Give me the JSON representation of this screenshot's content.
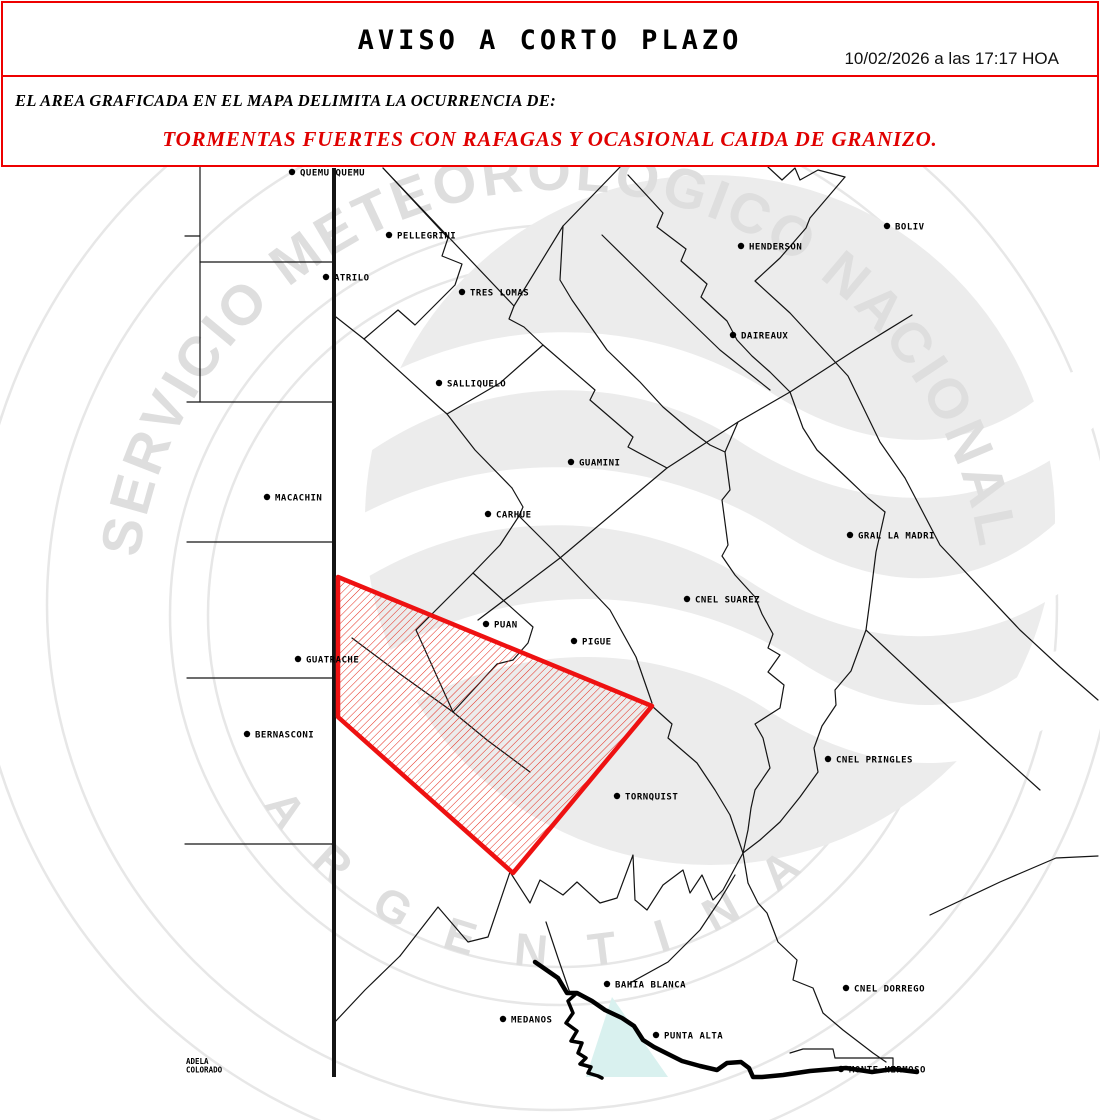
{
  "header": {
    "title": "AVISO A CORTO PLAZO",
    "timestamp": "10/02/2026 a las 17:17 HOA"
  },
  "advisory": {
    "intro": "EL AREA GRAFICADA EN EL MAPA DELIMITA LA OCURRENCIA DE:",
    "hazard": "TORMENTAS FUERTES CON RAFAGAS Y OCASIONAL CAIDA DE GRANIZO."
  },
  "map": {
    "colors": {
      "boundary": "#141414",
      "warning_red": "#ee1111",
      "hatch_red": "#e52819",
      "water": "#d9f1ef",
      "watermark": "#e7e7e7",
      "watermark_text": "#dedede",
      "logo_gray": "#ececec"
    },
    "watermark": {
      "arc_top": "SERVICIO METEOROLÓGICO NACIONAL",
      "arc_bottom": "A R G E N T I N A"
    },
    "province_border": {
      "x": 334,
      "y1": 168,
      "y2": 1077,
      "width": 4
    },
    "warning_area": {
      "points": [
        [
          338,
          577
        ],
        [
          652,
          706
        ],
        [
          513,
          873
        ],
        [
          338,
          717
        ]
      ]
    },
    "water_body": {
      "points": [
        [
          612,
          997
        ],
        [
          586,
          1077
        ],
        [
          668,
          1077
        ]
      ]
    },
    "coastline": [
      [
        535,
        962
      ],
      [
        558,
        978
      ],
      [
        567,
        993
      ],
      [
        577,
        993
      ],
      [
        592,
        1001
      ],
      [
        605,
        1010
      ],
      [
        622,
        1018
      ],
      [
        634,
        1026
      ],
      [
        643,
        1040
      ],
      [
        654,
        1047
      ],
      [
        668,
        1054
      ],
      [
        682,
        1061
      ],
      [
        700,
        1066
      ],
      [
        717,
        1070
      ],
      [
        727,
        1063
      ],
      [
        741,
        1062
      ],
      [
        749,
        1068
      ],
      [
        753,
        1077
      ],
      [
        762,
        1077
      ],
      [
        783,
        1075
      ],
      [
        810,
        1071
      ],
      [
        846,
        1068
      ],
      [
        872,
        1072
      ],
      [
        893,
        1069
      ],
      [
        917,
        1072
      ]
    ],
    "estuary_line": [
      [
        577,
        993
      ],
      [
        568,
        1001
      ],
      [
        573,
        1013
      ],
      [
        566,
        1023
      ],
      [
        577,
        1031
      ],
      [
        571,
        1041
      ],
      [
        582,
        1043
      ],
      [
        578,
        1053
      ],
      [
        586,
        1058
      ],
      [
        580,
        1064
      ],
      [
        591,
        1067
      ],
      [
        588,
        1073
      ],
      [
        598,
        1076
      ],
      [
        602,
        1078
      ]
    ],
    "boundaries": [
      [
        [
          185,
          236
        ],
        [
          200,
          236
        ]
      ],
      [
        [
          200,
          165
        ],
        [
          200,
          402
        ]
      ],
      [
        [
          200,
          262
        ],
        [
          334,
          262
        ]
      ],
      [
        [
          187,
          402
        ],
        [
          334,
          402
        ]
      ],
      [
        [
          187,
          542
        ],
        [
          334,
          542
        ]
      ],
      [
        [
          187,
          678
        ],
        [
          334,
          678
        ]
      ],
      [
        [
          185,
          844
        ],
        [
          334,
          844
        ]
      ],
      [
        [
          383,
          168
        ],
        [
          448,
          238
        ],
        [
          442,
          256
        ],
        [
          462,
          264
        ],
        [
          455,
          285
        ],
        [
          415,
          325
        ],
        [
          398,
          310
        ],
        [
          364,
          339
        ],
        [
          336,
          317
        ]
      ],
      [
        [
          383,
          168
        ],
        [
          514,
          306
        ],
        [
          509,
          319
        ],
        [
          524,
          327
        ],
        [
          543,
          345
        ]
      ],
      [
        [
          622,
          165
        ],
        [
          563,
          226
        ],
        [
          514,
          306
        ]
      ],
      [
        [
          364,
          339
        ],
        [
          440,
          408
        ],
        [
          447,
          414
        ],
        [
          475,
          450
        ],
        [
          512,
          488
        ]
      ],
      [
        [
          543,
          345
        ],
        [
          500,
          383
        ],
        [
          447,
          414
        ]
      ],
      [
        [
          543,
          345
        ],
        [
          595,
          390
        ],
        [
          590,
          400
        ],
        [
          633,
          437
        ],
        [
          628,
          447
        ],
        [
          667,
          468
        ]
      ],
      [
        [
          512,
          488
        ],
        [
          523,
          507
        ],
        [
          519,
          516
        ],
        [
          553,
          550
        ],
        [
          610,
          610
        ],
        [
          636,
          657
        ],
        [
          652,
          703
        ]
      ],
      [
        [
          519,
          516
        ],
        [
          500,
          545
        ],
        [
          473,
          573
        ]
      ],
      [
        [
          473,
          573
        ],
        [
          533,
          627
        ],
        [
          528,
          643
        ],
        [
          513,
          660
        ]
      ],
      [
        [
          473,
          573
        ],
        [
          443,
          603
        ],
        [
          416,
          630
        ]
      ],
      [
        [
          513,
          660
        ],
        [
          497,
          664
        ],
        [
          453,
          712
        ]
      ],
      [
        [
          416,
          630
        ],
        [
          453,
          712
        ]
      ],
      [
        [
          453,
          712
        ],
        [
          487,
          740
        ],
        [
          530,
          772
        ]
      ],
      [
        [
          352,
          638
        ],
        [
          400,
          674
        ],
        [
          453,
          712
        ]
      ],
      [
        [
          478,
          620
        ],
        [
          560,
          558
        ],
        [
          667,
          468
        ],
        [
          738,
          422
        ],
        [
          790,
          392
        ],
        [
          855,
          350
        ],
        [
          912,
          315
        ]
      ],
      [
        [
          738,
          422
        ],
        [
          725,
          452
        ],
        [
          730,
          490
        ],
        [
          722,
          500
        ],
        [
          728,
          545
        ],
        [
          722,
          556
        ],
        [
          735,
          575
        ],
        [
          755,
          597
        ],
        [
          762,
          614
        ],
        [
          773,
          634
        ],
        [
          768,
          648
        ],
        [
          780,
          655
        ],
        [
          768,
          672
        ],
        [
          784,
          685
        ],
        [
          780,
          708
        ],
        [
          755,
          724
        ],
        [
          763,
          738
        ],
        [
          770,
          768
        ],
        [
          755,
          790
        ],
        [
          751,
          808
        ],
        [
          748,
          830
        ],
        [
          743,
          853
        ]
      ],
      [
        [
          628,
          175
        ],
        [
          663,
          213
        ],
        [
          657,
          227
        ],
        [
          686,
          249
        ],
        [
          681,
          261
        ],
        [
          707,
          284
        ],
        [
          701,
          297
        ],
        [
          727,
          321
        ],
        [
          737,
          340
        ],
        [
          752,
          356
        ],
        [
          770,
          372
        ],
        [
          790,
          392
        ]
      ],
      [
        [
          790,
          392
        ],
        [
          803,
          428
        ],
        [
          817,
          450
        ],
        [
          847,
          478
        ],
        [
          868,
          498
        ],
        [
          885,
          512
        ]
      ],
      [
        [
          845,
          177
        ],
        [
          810,
          218
        ],
        [
          806,
          228
        ],
        [
          780,
          258
        ],
        [
          755,
          281
        ],
        [
          790,
          313
        ],
        [
          848,
          376
        ],
        [
          880,
          442
        ],
        [
          905,
          478
        ],
        [
          940,
          545
        ],
        [
          1020,
          630
        ],
        [
          1060,
          667
        ],
        [
          1098,
          700
        ]
      ],
      [
        [
          768,
          167
        ],
        [
          782,
          180
        ],
        [
          795,
          168
        ],
        [
          800,
          180
        ],
        [
          818,
          170
        ],
        [
          845,
          177
        ]
      ],
      [
        [
          602,
          235
        ],
        [
          660,
          292
        ],
        [
          720,
          350
        ],
        [
          770,
          390
        ]
      ],
      [
        [
          563,
          226
        ],
        [
          560,
          280
        ],
        [
          572,
          300
        ],
        [
          607,
          350
        ],
        [
          640,
          382
        ],
        [
          663,
          407
        ],
        [
          690,
          430
        ],
        [
          710,
          445
        ],
        [
          725,
          452
        ]
      ],
      [
        [
          885,
          512
        ],
        [
          876,
          552
        ],
        [
          870,
          600
        ],
        [
          866,
          630
        ],
        [
          851,
          671
        ],
        [
          835,
          690
        ],
        [
          836,
          705
        ],
        [
          822,
          726
        ],
        [
          814,
          748
        ],
        [
          818,
          772
        ],
        [
          800,
          797
        ],
        [
          780,
          822
        ],
        [
          760,
          840
        ],
        [
          743,
          853
        ]
      ],
      [
        [
          866,
          630
        ],
        [
          930,
          690
        ],
        [
          990,
          745
        ],
        [
          1040,
          790
        ]
      ],
      [
        [
          930,
          915
        ],
        [
          1000,
          882
        ],
        [
          1056,
          858
        ],
        [
          1098,
          856
        ]
      ],
      [
        [
          743,
          853
        ],
        [
          748,
          883
        ],
        [
          758,
          903
        ],
        [
          767,
          913
        ],
        [
          778,
          942
        ],
        [
          797,
          960
        ],
        [
          793,
          980
        ],
        [
          813,
          988
        ],
        [
          823,
          1013
        ],
        [
          843,
          1030
        ],
        [
          873,
          1053
        ],
        [
          886,
          1062
        ]
      ],
      [
        [
          400,
          956
        ],
        [
          438,
          907
        ],
        [
          468,
          942
        ],
        [
          488,
          937
        ],
        [
          510,
          872
        ],
        [
          530,
          903
        ],
        [
          540,
          880
        ],
        [
          563,
          895
        ],
        [
          577,
          882
        ],
        [
          600,
          903
        ],
        [
          617,
          898
        ],
        [
          633,
          855
        ],
        [
          635,
          900
        ],
        [
          647,
          910
        ],
        [
          663,
          885
        ],
        [
          683,
          870
        ],
        [
          690,
          893
        ],
        [
          702,
          875
        ],
        [
          713,
          900
        ],
        [
          723,
          890
        ],
        [
          743,
          853
        ]
      ],
      [
        [
          334,
          1023
        ],
        [
          365,
          990
        ],
        [
          400,
          956
        ]
      ],
      [
        [
          546,
          922
        ],
        [
          558,
          958
        ],
        [
          570,
          993
        ]
      ],
      [
        [
          630,
          983
        ],
        [
          668,
          962
        ],
        [
          700,
          930
        ],
        [
          720,
          900
        ],
        [
          735,
          875
        ]
      ],
      [
        [
          652,
          706
        ],
        [
          672,
          724
        ],
        [
          668,
          738
        ],
        [
          697,
          763
        ],
        [
          715,
          790
        ],
        [
          730,
          815
        ],
        [
          743,
          853
        ]
      ],
      [
        [
          790,
          1053
        ],
        [
          803,
          1049
        ],
        [
          833,
          1049
        ],
        [
          835,
          1058
        ],
        [
          893,
          1058
        ],
        [
          893,
          1068
        ]
      ]
    ],
    "towns": [
      {
        "x": 292,
        "y": 172,
        "label": "QUEMU QUEMU"
      },
      {
        "x": 389,
        "y": 235,
        "label": "PELLEGRINI"
      },
      {
        "x": 326,
        "y": 277,
        "label": "ATRILO"
      },
      {
        "x": 462,
        "y": 292,
        "label": "TRES LOMAS"
      },
      {
        "x": 741,
        "y": 246,
        "label": "HENDERSON"
      },
      {
        "x": 887,
        "y": 226,
        "label": "BOLIV"
      },
      {
        "x": 733,
        "y": 335,
        "label": "DAIREAUX"
      },
      {
        "x": 439,
        "y": 383,
        "label": "SALLIQUELO"
      },
      {
        "x": 571,
        "y": 462,
        "label": "GUAMINI"
      },
      {
        "x": 488,
        "y": 514,
        "label": "CARHUE"
      },
      {
        "x": 267,
        "y": 497,
        "label": "MACACHIN"
      },
      {
        "x": 850,
        "y": 535,
        "label": "GRAL LA MADRI"
      },
      {
        "x": 687,
        "y": 599,
        "label": "CNEL SUAREZ"
      },
      {
        "x": 486,
        "y": 624,
        "label": "PUAN"
      },
      {
        "x": 574,
        "y": 641,
        "label": "PIGUE"
      },
      {
        "x": 298,
        "y": 659,
        "label": "GUATRACHE"
      },
      {
        "x": 247,
        "y": 734,
        "label": "BERNASCONI"
      },
      {
        "x": 828,
        "y": 759,
        "label": "CNEL PRINGLES"
      },
      {
        "x": 617,
        "y": 796,
        "label": "TORNQUIST"
      },
      {
        "x": 607,
        "y": 984,
        "label": "BAHIA BLANCA"
      },
      {
        "x": 846,
        "y": 988,
        "label": "CNEL DORREGO"
      },
      {
        "x": 503,
        "y": 1019,
        "label": "MEDANOS"
      },
      {
        "x": 656,
        "y": 1035,
        "label": "PUNTA ALTA"
      },
      {
        "x": 841,
        "y": 1069,
        "label": "MONTE HERMOSO"
      }
    ],
    "corner_label": {
      "x": 186,
      "y": 1064,
      "lines": [
        "ADELA",
        "COLORADO"
      ]
    }
  }
}
